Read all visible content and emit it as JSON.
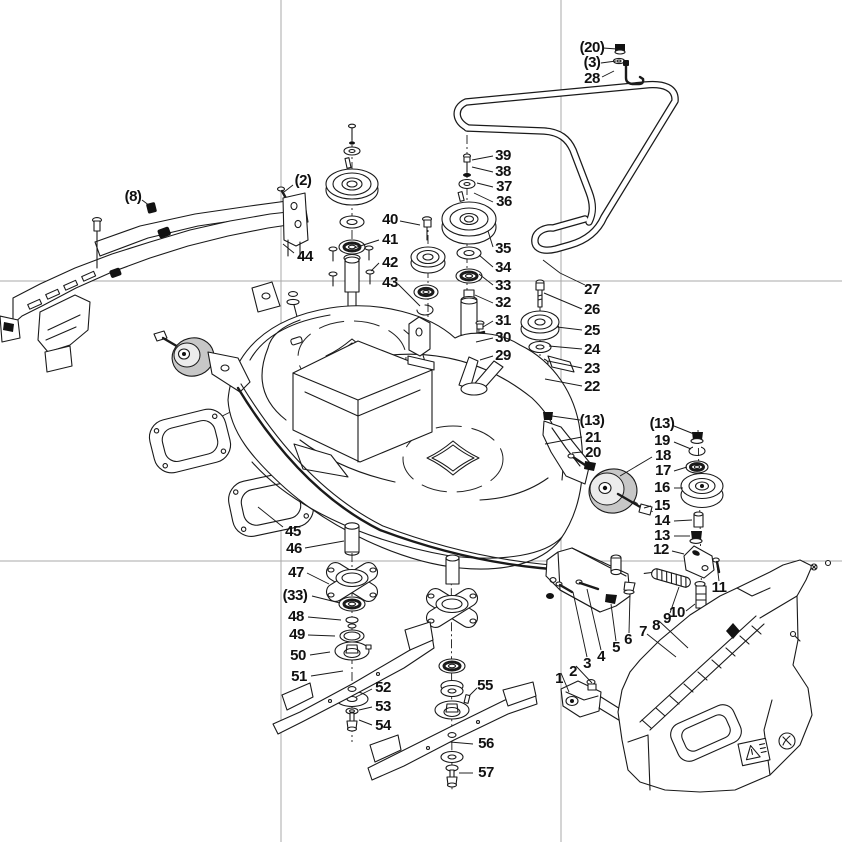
{
  "figure": {
    "type": "exploded-parts-diagram",
    "subject": "mower-deck-assembly",
    "background_color": "#ffffff",
    "line_color": "#1a1a1a",
    "registration_line_color": "#a9a9a9",
    "wheel_fill_color": "#c7c7c7"
  },
  "callouts": [
    {
      "label": "1",
      "x": 559,
      "y": 679
    },
    {
      "label": "2",
      "x": 573,
      "y": 672
    },
    {
      "label": "3",
      "x": 587,
      "y": 664
    },
    {
      "label": "4",
      "x": 601,
      "y": 657
    },
    {
      "label": "5",
      "x": 616,
      "y": 648
    },
    {
      "label": "6",
      "x": 628,
      "y": 640
    },
    {
      "label": "7",
      "x": 643,
      "y": 632
    },
    {
      "label": "8",
      "x": 656,
      "y": 626
    },
    {
      "label": "9",
      "x": 667,
      "y": 619
    },
    {
      "label": "10",
      "x": 677,
      "y": 613
    },
    {
      "label": "11",
      "x": 719,
      "y": 588
    },
    {
      "label": "12",
      "x": 661,
      "y": 550
    },
    {
      "label": "13",
      "x": 662,
      "y": 536
    },
    {
      "label": "14",
      "x": 662,
      "y": 521
    },
    {
      "label": "15",
      "x": 662,
      "y": 506
    },
    {
      "label": "16",
      "x": 662,
      "y": 488
    },
    {
      "label": "17",
      "x": 663,
      "y": 471
    },
    {
      "label": "18",
      "x": 663,
      "y": 456
    },
    {
      "label": "19",
      "x": 662,
      "y": 441
    },
    {
      "label": "(13)",
      "x": 662,
      "y": 424
    },
    {
      "label": "(13)",
      "x": 592,
      "y": 421
    },
    {
      "label": "20",
      "x": 593,
      "y": 453
    },
    {
      "label": "21",
      "x": 593,
      "y": 438
    },
    {
      "label": "22",
      "x": 592,
      "y": 387
    },
    {
      "label": "23",
      "x": 592,
      "y": 369
    },
    {
      "label": "24",
      "x": 592,
      "y": 350
    },
    {
      "label": "25",
      "x": 592,
      "y": 331
    },
    {
      "label": "26",
      "x": 592,
      "y": 310
    },
    {
      "label": "27",
      "x": 592,
      "y": 290
    },
    {
      "label": "28",
      "x": 592,
      "y": 79
    },
    {
      "label": "(3)",
      "x": 592,
      "y": 63
    },
    {
      "label": "(20)",
      "x": 592,
      "y": 48
    },
    {
      "label": "29",
      "x": 503,
      "y": 356
    },
    {
      "label": "30",
      "x": 503,
      "y": 338
    },
    {
      "label": "31",
      "x": 503,
      "y": 321
    },
    {
      "label": "32",
      "x": 503,
      "y": 303
    },
    {
      "label": "33",
      "x": 503,
      "y": 286
    },
    {
      "label": "34",
      "x": 503,
      "y": 268
    },
    {
      "label": "35",
      "x": 503,
      "y": 249
    },
    {
      "label": "36",
      "x": 504,
      "y": 202
    },
    {
      "label": "37",
      "x": 504,
      "y": 187
    },
    {
      "label": "38",
      "x": 503,
      "y": 172
    },
    {
      "label": "39",
      "x": 503,
      "y": 156
    },
    {
      "label": "40",
      "x": 390,
      "y": 220
    },
    {
      "label": "41",
      "x": 390,
      "y": 240
    },
    {
      "label": "42",
      "x": 390,
      "y": 263
    },
    {
      "label": "43",
      "x": 390,
      "y": 283
    },
    {
      "label": "44",
      "x": 305,
      "y": 257
    },
    {
      "label": "(2)",
      "x": 303,
      "y": 181
    },
    {
      "label": "(8)",
      "x": 133,
      "y": 197
    },
    {
      "label": "45",
      "x": 293,
      "y": 532
    },
    {
      "label": "46",
      "x": 294,
      "y": 549
    },
    {
      "label": "47",
      "x": 296,
      "y": 573
    },
    {
      "label": "(33)",
      "x": 295,
      "y": 596
    },
    {
      "label": "48",
      "x": 296,
      "y": 617
    },
    {
      "label": "49",
      "x": 297,
      "y": 635
    },
    {
      "label": "50",
      "x": 298,
      "y": 656
    },
    {
      "label": "51",
      "x": 299,
      "y": 677
    },
    {
      "label": "52",
      "x": 383,
      "y": 688
    },
    {
      "label": "53",
      "x": 383,
      "y": 707
    },
    {
      "label": "54",
      "x": 383,
      "y": 726
    },
    {
      "label": "55",
      "x": 485,
      "y": 686
    },
    {
      "label": "56",
      "x": 486,
      "y": 744
    },
    {
      "label": "57",
      "x": 486,
      "y": 773
    }
  ]
}
